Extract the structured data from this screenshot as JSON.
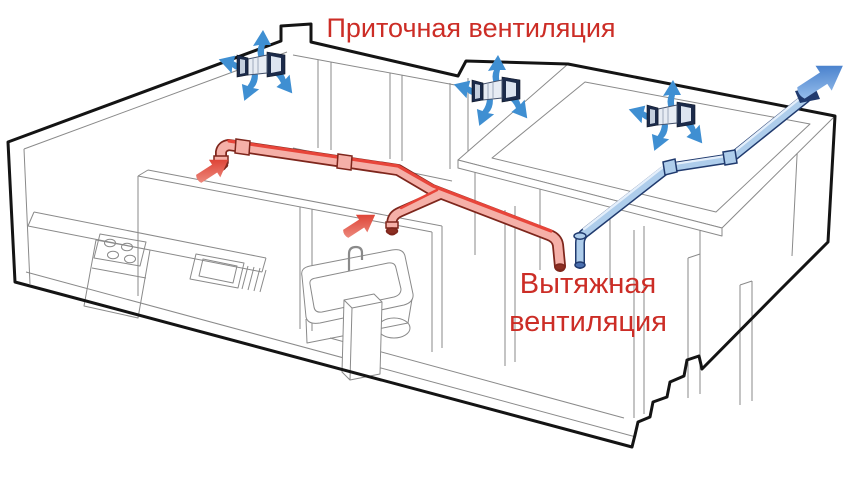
{
  "diagram": {
    "title": "Приточная вентиляция",
    "exhaust_label": {
      "line1": "Вытяжная",
      "line2": "вентиляция"
    }
  },
  "components": {
    "supply_fan_count": 3,
    "supply_inlet_arrows": 2,
    "exhaust_roof_outlets": 1
  },
  "icons": {
    "supply_fan": "wall-fan-unit",
    "airflow_arrow": "block-arrow",
    "roof_outlet_arrow": "block-arrow-up-right"
  },
  "colors": {
    "background": "#ffffff",
    "label_text": "#cc2d26",
    "line_thin": "#8a8a8a",
    "line_thick": "#141414",
    "supply_body": "#f5b0a8",
    "supply_top": "#e8453a",
    "supply_outline": "#7e261c",
    "supply_mouth": "#8c2e22",
    "supply_arrow_light": "#f09a8e",
    "supply_arrow_dark": "#d92b1d",
    "exhaust_body": "#aecdeb",
    "exhaust_top": "#e4effb",
    "exhaust_outline": "#203a6e",
    "exhaust_mouth": "#4a6fae",
    "exhaust_arrow_light": "#a7cbf2",
    "exhaust_arrow_dark": "#2e6cc2",
    "fan_arrow": "#3f8fd2",
    "fan_dark": "#1c2b4a",
    "fan_body": "#e7ecf4"
  }
}
